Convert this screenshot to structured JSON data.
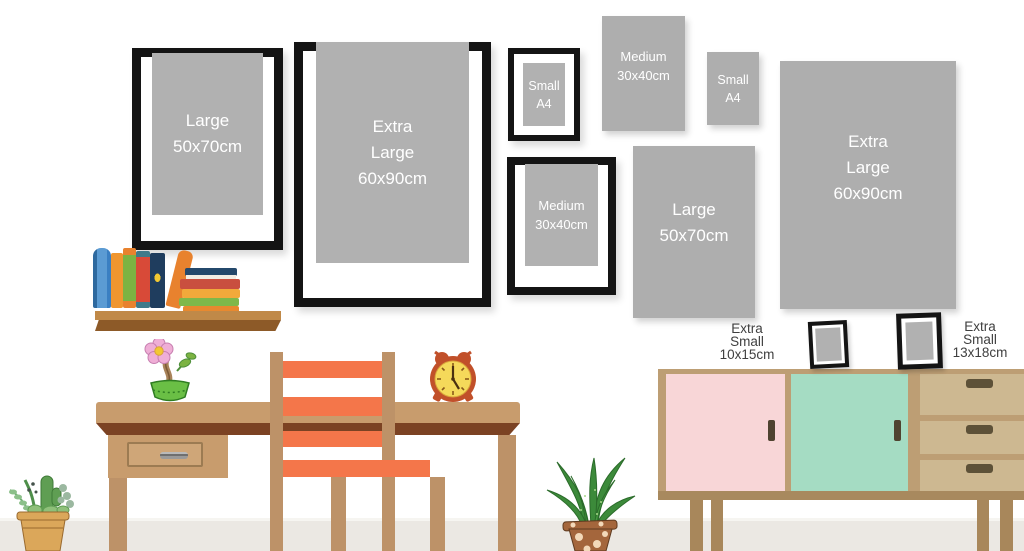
{
  "scene": {
    "description_visible_text_only": true
  },
  "frames": {
    "wall": [
      {
        "lines": [
          "Large",
          "50x70cm"
        ],
        "framed": true
      },
      {
        "lines": [
          "Extra",
          "Large",
          "60x90cm"
        ],
        "framed": true
      },
      {
        "lines": [
          "Small",
          "A4"
        ],
        "framed": true
      },
      {
        "lines": [
          "Medium",
          "30x40cm"
        ],
        "framed": false
      },
      {
        "lines": [
          "Small",
          "A4"
        ],
        "framed": false
      },
      {
        "lines": [
          "Medium",
          "30x40cm"
        ],
        "framed": true
      },
      {
        "lines": [
          "Large",
          "50x70cm"
        ],
        "framed": false
      },
      {
        "lines": [
          "Extra",
          "Large",
          "60x90cm"
        ],
        "framed": false
      }
    ],
    "standing": [
      {
        "lines": [
          "Extra",
          "Small",
          "10x15cm"
        ],
        "label_side": "left"
      },
      {
        "lines": [
          "Extra",
          "Small",
          "13x18cm"
        ],
        "label_side": "right"
      }
    ]
  },
  "colors": {
    "frame_black": "#141414",
    "print_gray": "#b1b1b1",
    "mat_white": "#ffffff",
    "frame_text": "#ffffff",
    "label_text": "#3f3f3f",
    "wall_white": "#ffffff",
    "floor_gray": "#ebe8e3",
    "wood_tan": "#c89c6d",
    "wood_apron_dark": "#7b4223",
    "chair_orange": "#f4764a",
    "shelf_brown": "#8d5a28",
    "sideboard_tan": "#bd9e74",
    "sideboard_drawer": "#cdb891",
    "door_pink": "#f8d6d7",
    "door_mint": "#a5dcc3",
    "handle_dark": "#4f4330",
    "clock_red": "#c1502a",
    "clock_face_yellow": "#f5d95a",
    "plant_green": "#3c8a3a",
    "pot_terracotta": "#a4663c"
  }
}
